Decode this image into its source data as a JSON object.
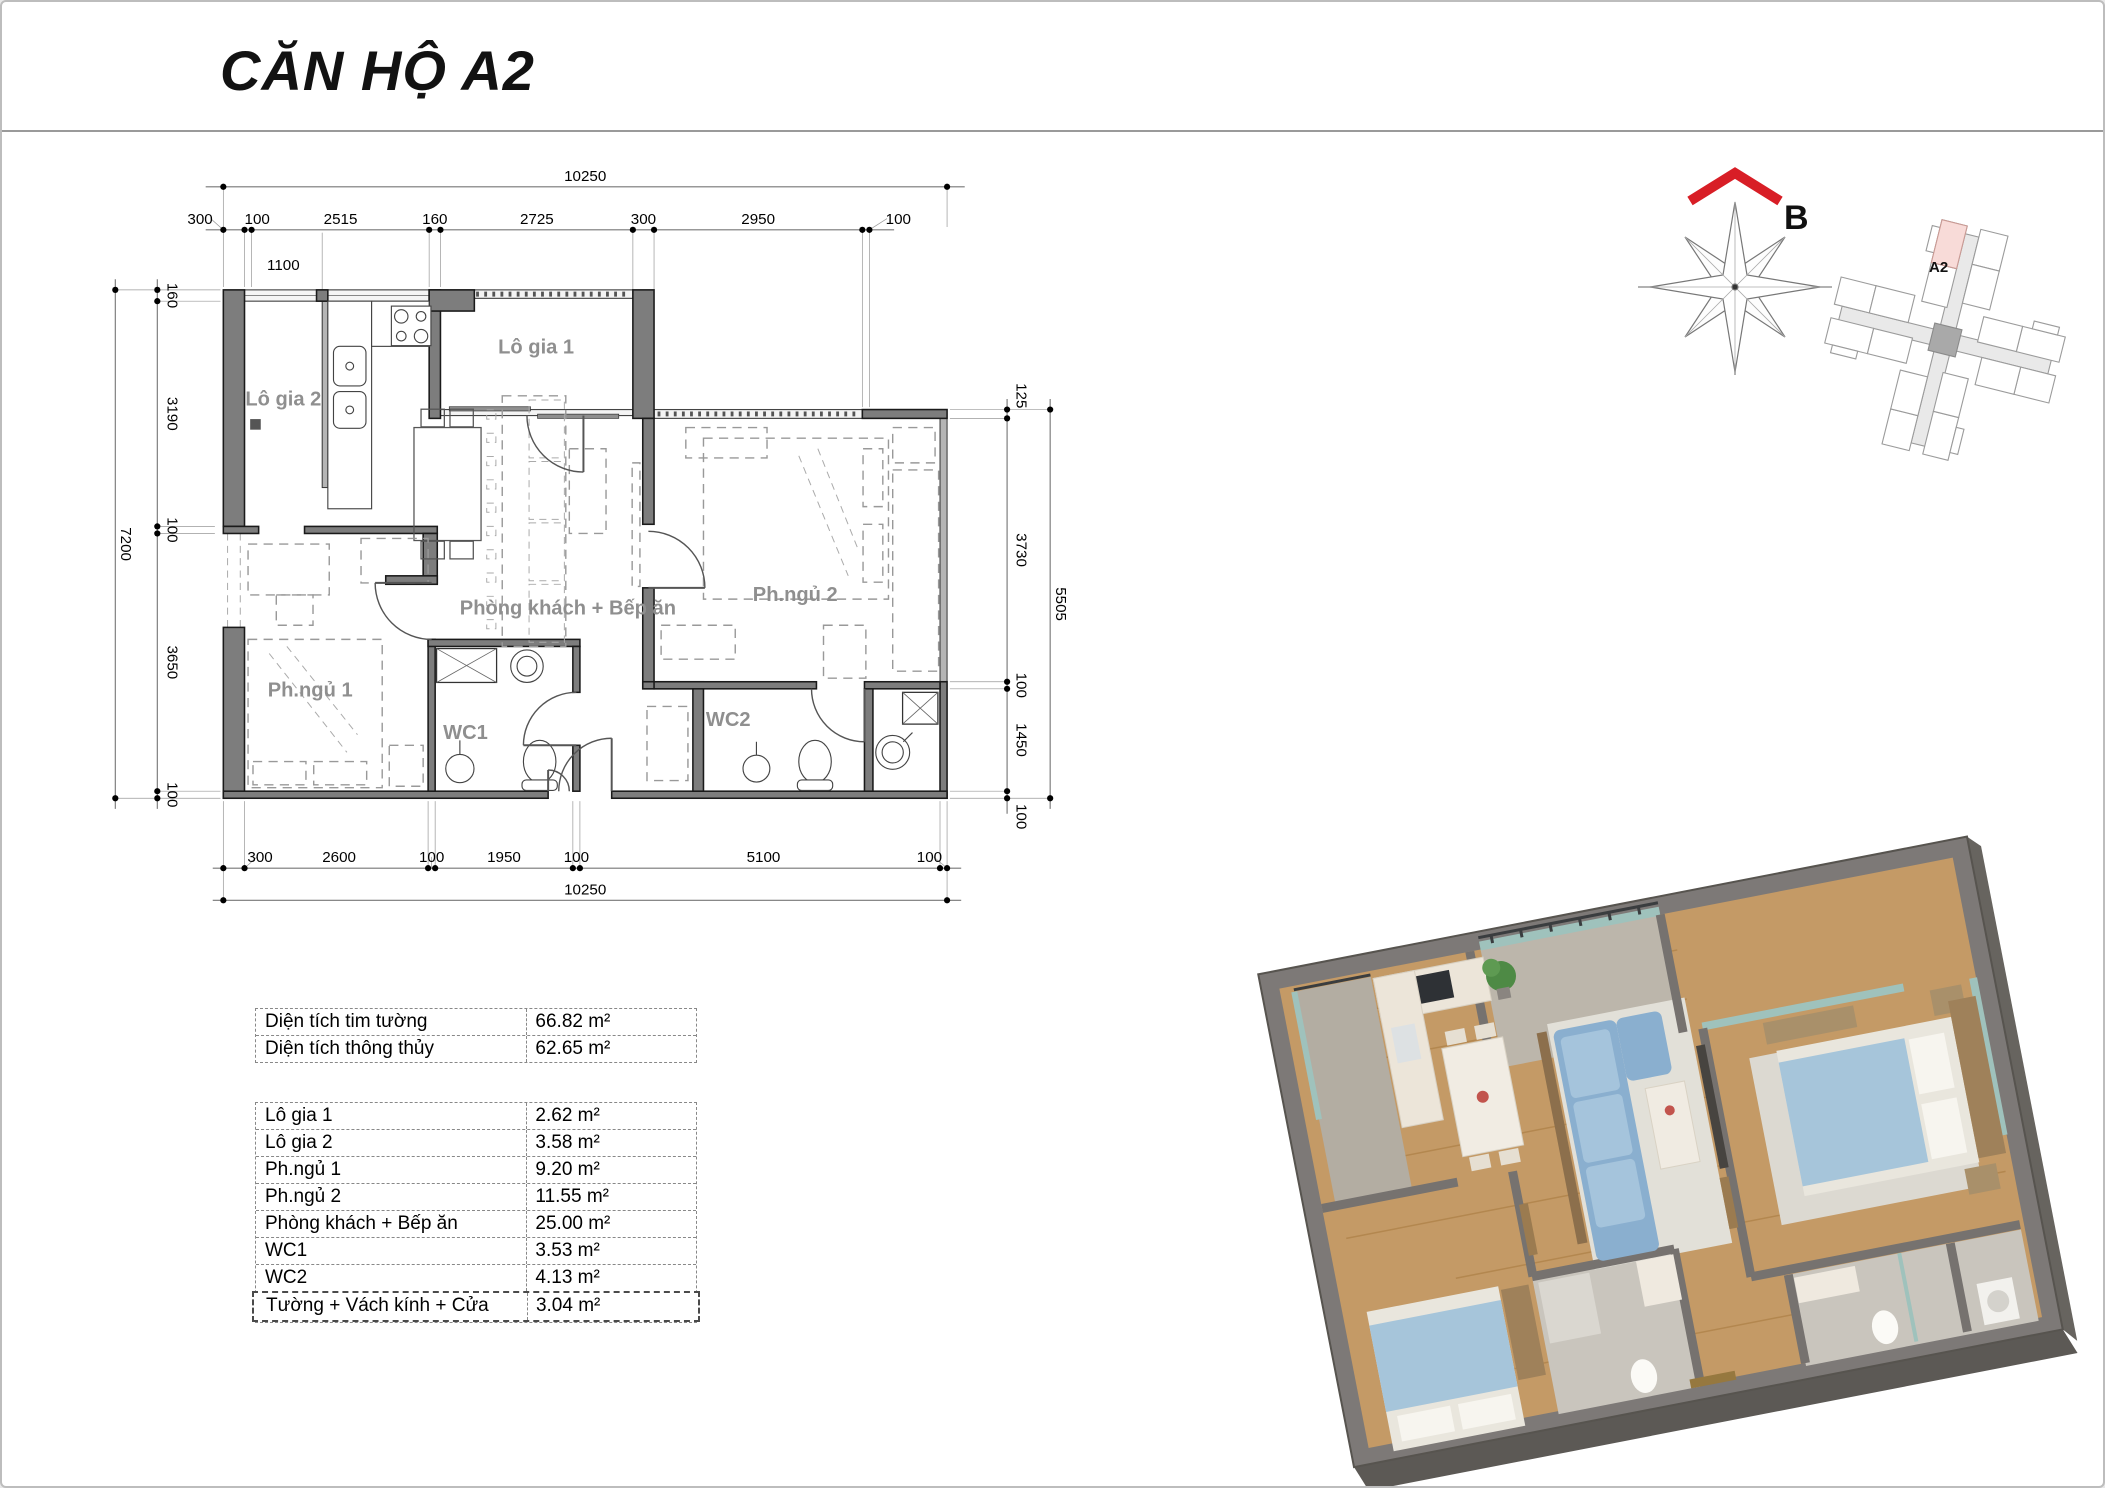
{
  "page": {
    "title": "CĂN HỘ A2"
  },
  "plan": {
    "rooms": {
      "logia1": "Lô gia 1",
      "logia2": "Lô gia 2",
      "living": "Phòng khách + Bếp ăn",
      "bed1": "Ph.ngủ 1",
      "bed2": "Ph.ngủ 2",
      "wc1": "WC1",
      "wc2": "WC2"
    },
    "dims": {
      "top_total": "10250",
      "top_chain": [
        "300",
        "100",
        "2515",
        "160",
        "2725",
        "300",
        "2950",
        "100"
      ],
      "top_sub": "1100",
      "left_total": "7200",
      "left_chain": [
        "160",
        "3190",
        "100",
        "3650",
        "100"
      ],
      "right_total": "5505",
      "right_chain": [
        "125",
        "3730",
        "100",
        "1450",
        "100"
      ],
      "bottom_total": "10250",
      "bottom_chain": [
        "300",
        "2600",
        "100",
        "1950",
        "100",
        "5100",
        "100"
      ]
    }
  },
  "compass": {
    "north_label": "B"
  },
  "locator": {
    "unit_label": "A2"
  },
  "tables": {
    "summary": [
      {
        "label": "Diện tích tim tường",
        "value": "66.82 m²"
      },
      {
        "label": "Diện tích thông thủy",
        "value": "62.65 m²"
      }
    ],
    "areas": [
      {
        "label": "Lô gia 1",
        "value": "2.62 m²"
      },
      {
        "label": "Lô gia 2",
        "value": "3.58 m²"
      },
      {
        "label": "Ph.ngủ 1",
        "value": "9.20 m²"
      },
      {
        "label": "Ph.ngủ 2",
        "value": "11.55 m²"
      },
      {
        "label": "Phòng khách + Bếp ăn",
        "value": "25.00 m²"
      },
      {
        "label": "WC1",
        "value": "3.53 m²"
      },
      {
        "label": "WC2",
        "value": "4.13 m²"
      },
      {
        "label": "Tường + Vách kính + Cửa",
        "value": "3.04 m²"
      }
    ]
  },
  "colors": {
    "accent_red": "#d81e26",
    "wall_gray": "#7d7d7d",
    "label_gray": "#8f8f8f",
    "unit_highlight": "#f8dbd8",
    "wood": "#c49a66",
    "sofa_blue": "#8aafcf"
  }
}
